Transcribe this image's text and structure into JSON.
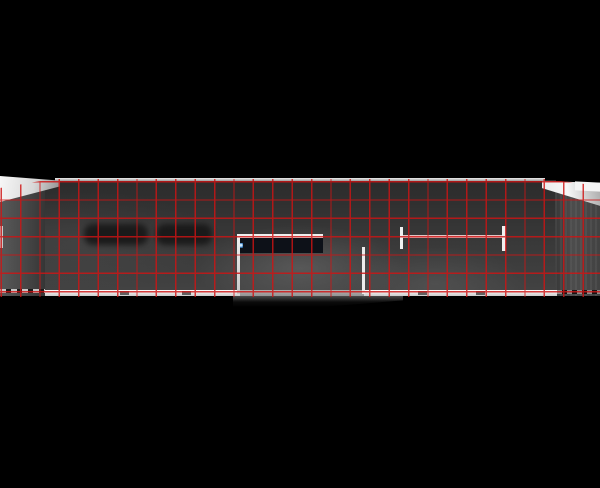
{
  "scene": {
    "title": "night elevation rendering of flat-roofed pavilion with red modular grid overlay",
    "background_color": "#000000"
  },
  "colors": {
    "bg": "#000000",
    "facade_top": "#2b2b2b",
    "facade_mid": "#383838",
    "facade_bottom": "#434343",
    "grid_line": "#cf1414",
    "trim_white": "#efefef",
    "wedge_light": "#f7f7f7",
    "wedge_shade": "#8e8e8e",
    "led_dark": "#0d1118",
    "led_ring": "#3a7fc1",
    "led_core": "#cfe9ff",
    "beam_tint": "#e2c4c4",
    "bar_dark": "#161616"
  },
  "grid": {
    "cell_width_px": 19.4,
    "cell_height_px": 18.33,
    "line_width_px": 1.4,
    "offset_x_px": 0.5,
    "offset_y_px": 2,
    "opacity": 0.82,
    "columns_visible": 31,
    "rows_visible": 6
  },
  "entrance": {
    "led": {
      "rows": 2,
      "columns": 13
    }
  },
  "bottom_strip": {
    "marks_x": [
      120,
      182,
      418,
      476
    ]
  },
  "labels": {
    "canvas": "architectural rendering with red grid overlay",
    "grid": "red modular grid overlay",
    "entrance": "recessed entrance with LED strip",
    "beam": "I-beam sign support",
    "strip": "white base strip"
  }
}
